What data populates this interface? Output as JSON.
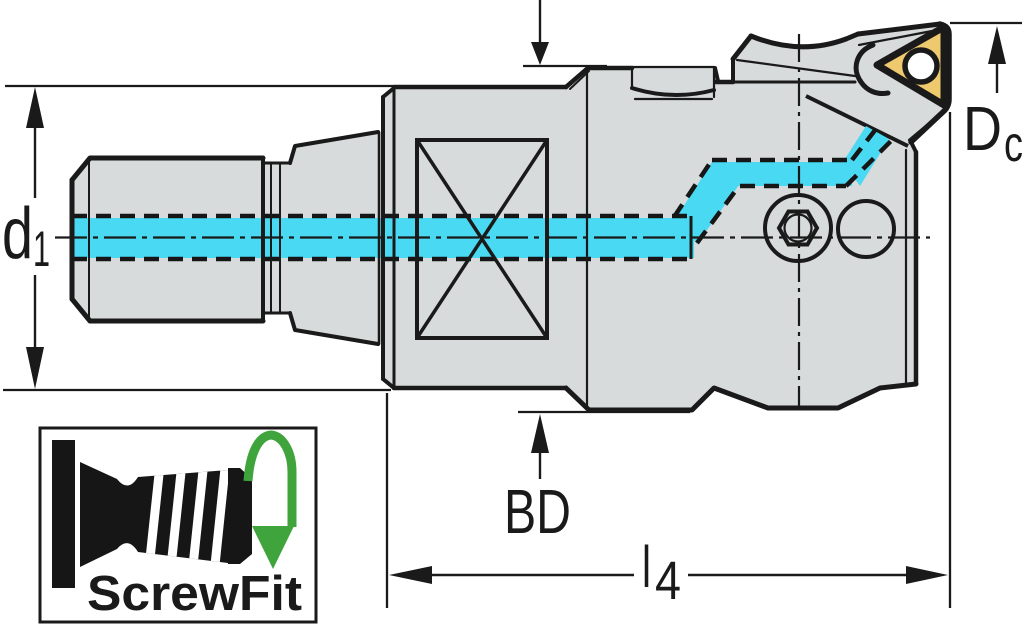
{
  "drawing": {
    "type": "technical-dimension-drawing",
    "labels": {
      "d1": {
        "base": "d",
        "sub": "1"
      },
      "Dc": {
        "base": "D",
        "sub": "c"
      },
      "BD": {
        "text": "BD"
      },
      "l4": {
        "base": "l",
        "sub": "4"
      }
    },
    "logo": {
      "text": "ScrewFit"
    },
    "colors": {
      "coolant_cyan": "#4AD9F2",
      "insert_yellow": "#EFC96D",
      "body_gray": "#D7DBDB",
      "line_black": "#1A1A1A",
      "logo_green": "#3FA43B"
    }
  }
}
